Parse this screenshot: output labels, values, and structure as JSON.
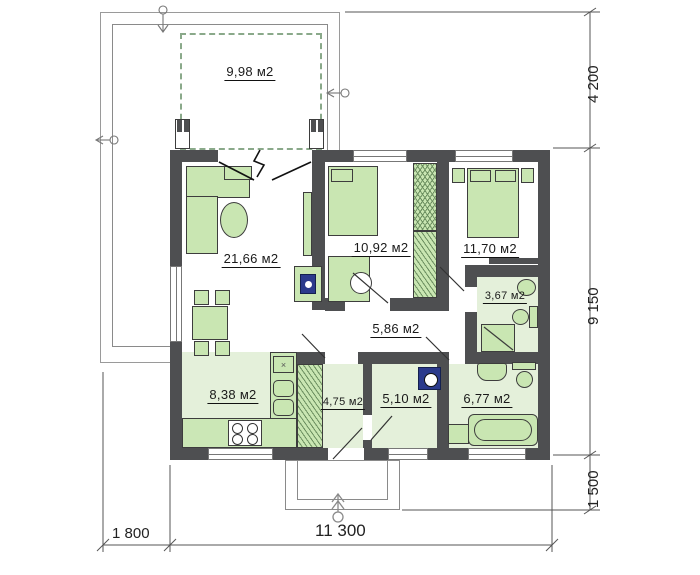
{
  "rooms": {
    "terrace": "9,98 м2",
    "living_room": "21,66 м2",
    "bedroom_top": "10,92 м2",
    "bedroom_right": "11,70 м2",
    "shower_room": "3,67 м2",
    "hallway": "5,86 м2",
    "kitchen": "8,38 м2",
    "entry": "4,75 м2",
    "utility": "5,10 м2",
    "bathroom": "6,77 м2"
  },
  "dimensions": {
    "right": [
      "4 200",
      "9 150",
      "1 500"
    ],
    "bottom": [
      "1 800",
      "11 300"
    ]
  },
  "colors": {
    "wall": "#4e4f51",
    "furniture_green": "#c9e6b2",
    "floor_green": "#e4f0da",
    "appliance_navy": "#2b3a8c",
    "terrace_dash": "#8aa98a"
  }
}
